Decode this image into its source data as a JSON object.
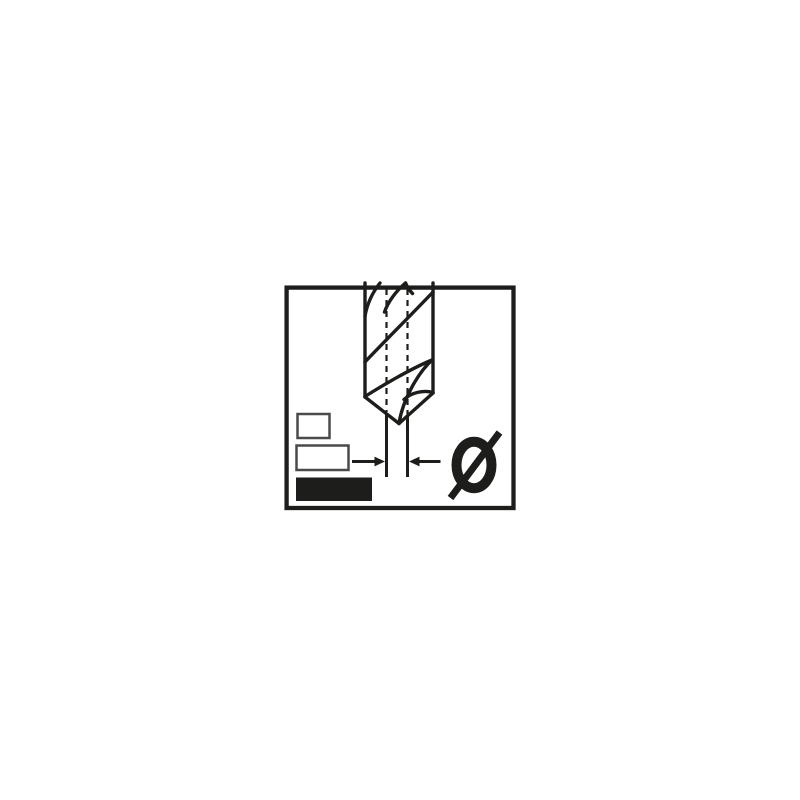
{
  "pictogram": {
    "name": "drill-bit-diameter-pictogram",
    "diameter_symbol": "Ø",
    "ink_color": "#1d1d1b",
    "outline_gray": "#4a4a4a",
    "background_color": "#ffffff"
  }
}
